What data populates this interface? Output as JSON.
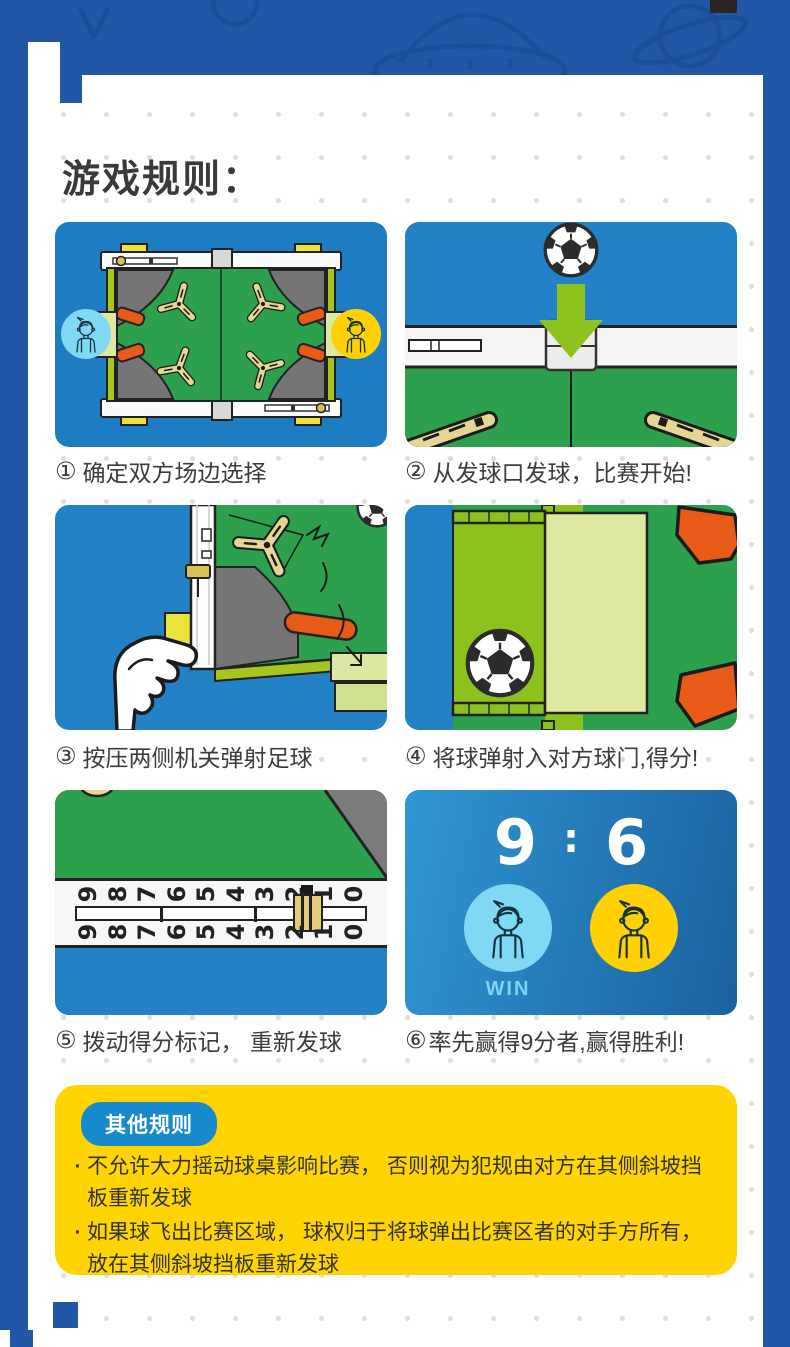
{
  "page": {
    "title": "游戏规则："
  },
  "steps": [
    {
      "num": "①",
      "label": "确定双方场边选择"
    },
    {
      "num": "②",
      "label": "从发球口发球，比赛开始!"
    },
    {
      "num": "③",
      "label": "按压两侧机关弹射足球"
    },
    {
      "num": "④",
      "label": "将球弹射入对方球门,得分!"
    },
    {
      "num": "⑤",
      "label": "拨动得分标记， 重新发球"
    },
    {
      "num": "⑥",
      "label": "率先赢得9分者,赢得胜利!"
    }
  ],
  "scoreboard": {
    "left_score": "9",
    "separator": ":",
    "right_score": "6",
    "win_label": "WIN"
  },
  "score_rail": {
    "numbers": [
      "9",
      "8",
      "7",
      "6",
      "5",
      "4",
      "3",
      "2",
      "1",
      "0"
    ],
    "marker_at": "2"
  },
  "other_rules": {
    "badge": "其他规则",
    "bullet": "·",
    "items": [
      "不允许大力摇动球桌影响比赛， 否则视为犯规由对方在其侧斜坡挡板重新发球",
      "如果球飞出比赛区域， 球权归于将球弹出比赛区者的对手方所有，放在其侧斜坡挡板重新发球"
    ]
  },
  "icons": {
    "players": "boy-avatar-icon",
    "ball": "soccer-ball-icon",
    "serve": "down-arrow-icon",
    "press": "hand-press-icon"
  },
  "colors": {
    "frame_blue": "#2157a6",
    "panel_blue": "#2381c5",
    "field_green": "#2da04e",
    "lime": "#8cc21d",
    "pale_lime": "#dde8a0",
    "orange": "#e85a17",
    "gray": "#757575",
    "yellow_box": "#ffd400",
    "badge_blue": "#1789cd",
    "avatar_cyan": "#7fd9f2",
    "avatar_yellow": "#ffd103",
    "win_text": "#7fd4ee",
    "launcher_tan": "#e6d693"
  }
}
